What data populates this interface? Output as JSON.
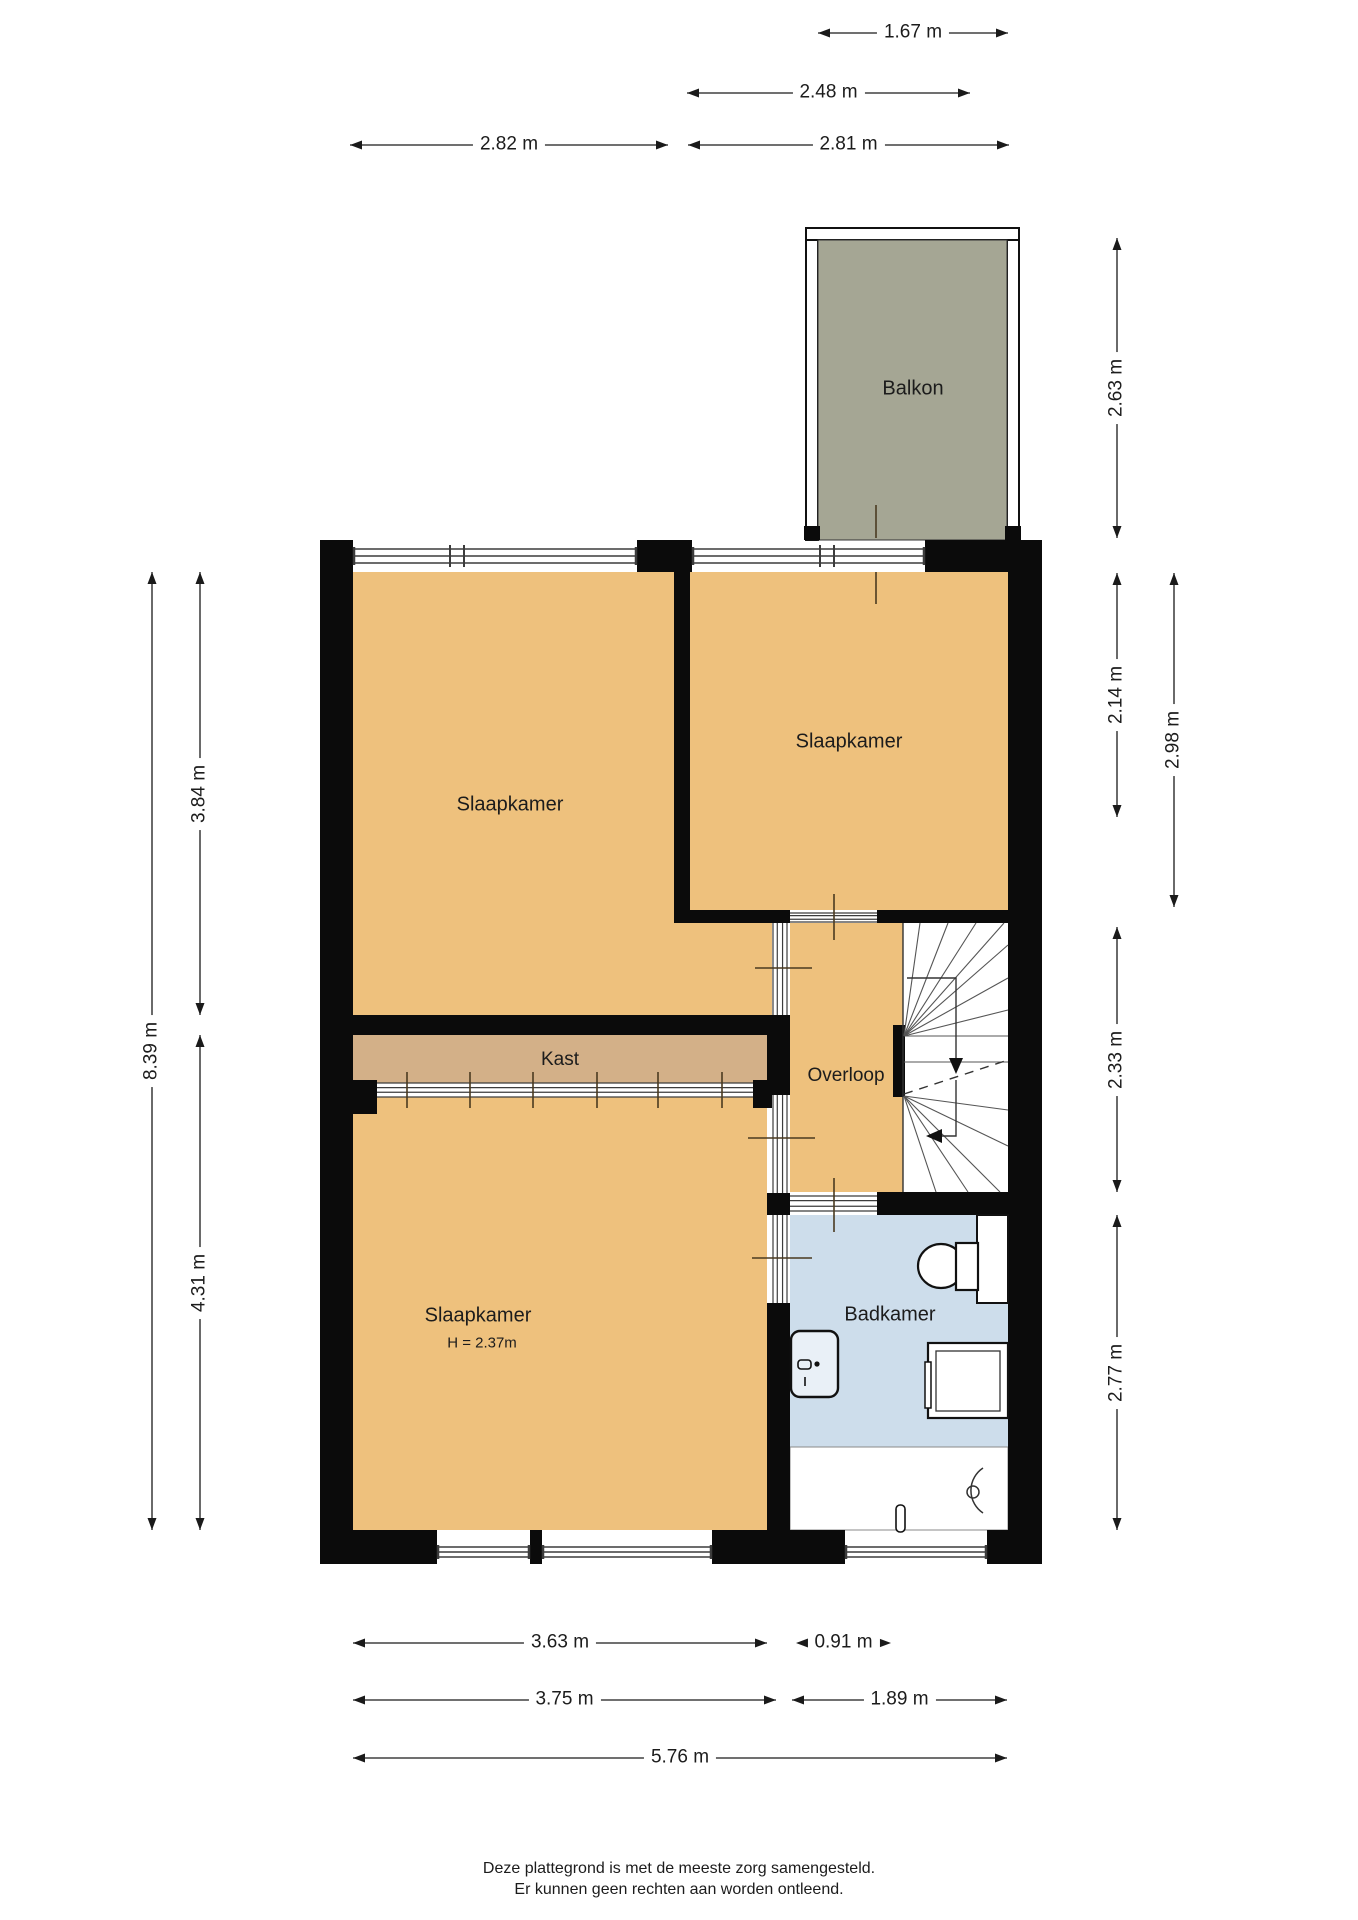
{
  "canvas": {
    "w": 1358,
    "h": 1920,
    "bg": "#ffffff"
  },
  "colors": {
    "wall": "#0b0b0b",
    "room": "#eec17d",
    "kast": "#d3b088",
    "bath": "#cdddeb",
    "balcony": "#a5a694",
    "dimline": "#1a1a1a",
    "stairline": "#555555",
    "glazeline": "#3c3c3c"
  },
  "rooms": [
    {
      "name": "room-slaapkamer-left",
      "x": 353,
      "y": 572,
      "w": 321,
      "h": 443,
      "fill": "room"
    },
    {
      "name": "room-slaapkamer-left-passage",
      "x": 674,
      "y": 923,
      "w": 98,
      "h": 92,
      "fill": "room"
    },
    {
      "name": "room-slaapkamer-right",
      "x": 690,
      "y": 572,
      "w": 318,
      "h": 338,
      "fill": "room"
    },
    {
      "name": "room-overloop",
      "x": 790,
      "y": 923,
      "w": 113,
      "h": 269,
      "fill": "room"
    },
    {
      "name": "room-kast",
      "x": 353,
      "y": 1035,
      "w": 414,
      "h": 48,
      "fill": "kast"
    },
    {
      "name": "room-slaapkamer-bottom",
      "x": 353,
      "y": 1097,
      "w": 414,
      "h": 433,
      "fill": "room"
    },
    {
      "name": "room-badkamer",
      "x": 790,
      "y": 1215,
      "w": 218,
      "h": 232,
      "fill": "bath"
    },
    {
      "name": "room-badkamer-shower-zone",
      "x": 790,
      "y": 1447,
      "w": 218,
      "h": 83,
      "fill": "#ffffff",
      "stroke": "#8a8a8a"
    },
    {
      "name": "room-stairwell",
      "x": 903,
      "y": 923,
      "w": 105,
      "h": 269,
      "fill": "#ffffff"
    }
  ],
  "walls": [
    [
      320,
      540,
      33,
      32
    ],
    [
      637,
      540,
      55,
      32
    ],
    [
      925,
      540,
      117,
      32
    ],
    [
      320,
      540,
      33,
      1024
    ],
    [
      1008,
      540,
      34,
      1024
    ],
    [
      320,
      1530,
      117,
      34
    ],
    [
      530,
      1530,
      12,
      34
    ],
    [
      712,
      1530,
      133,
      34
    ],
    [
      987,
      1530,
      55,
      34
    ],
    [
      674,
      572,
      16,
      351
    ],
    [
      674,
      910,
      116,
      13
    ],
    [
      877,
      910,
      131,
      13
    ],
    [
      353,
      1015,
      417,
      20
    ],
    [
      767,
      1015,
      23,
      80
    ],
    [
      767,
      1193,
      23,
      22
    ],
    [
      767,
      1303,
      23,
      227
    ],
    [
      353,
      1080,
      24,
      34
    ],
    [
      753,
      1080,
      24,
      28
    ],
    [
      877,
      1192,
      131,
      23
    ],
    [
      893,
      1025,
      12,
      72
    ]
  ],
  "windows": [
    {
      "name": "window-top-left",
      "x1": 353,
      "x2": 637,
      "y": 548,
      "h": 16,
      "mullions": [
        450,
        464
      ]
    },
    {
      "name": "window-balcony-door",
      "x1": 692,
      "x2": 925,
      "y": 548,
      "h": 16,
      "mullions": [
        820,
        834
      ]
    },
    {
      "name": "window-bottom-left-a",
      "x1": 437,
      "x2": 530,
      "y": 1546,
      "h": 12,
      "mullions": []
    },
    {
      "name": "window-bottom-left-b",
      "x1": 542,
      "x2": 712,
      "y": 1546,
      "h": 12,
      "mullions": []
    },
    {
      "name": "window-bottom-badkamer",
      "x1": 845,
      "x2": 987,
      "y": 1546,
      "h": 12,
      "mullions": []
    }
  ],
  "glazings": [
    {
      "name": "opening-passage-overloop",
      "x": 772,
      "y": 923,
      "w": 16,
      "h": 92,
      "o": "v"
    },
    {
      "name": "door-slaapkamer-overloop",
      "x": 772,
      "y": 1095,
      "w": 16,
      "h": 98,
      "o": "v"
    },
    {
      "name": "door-slaapkamer-badkamer",
      "x": 772,
      "y": 1215,
      "w": 16,
      "h": 88,
      "o": "v"
    },
    {
      "name": "door-slaapkamer-right-overloop",
      "x": 790,
      "y": 912,
      "w": 87,
      "h": 11,
      "o": "h"
    },
    {
      "name": "door-overloop-badkamer",
      "x": 790,
      "y": 1195,
      "w": 87,
      "h": 17,
      "o": "h"
    }
  ],
  "door_marks": [
    [
      834,
      894,
      834,
      940
    ],
    [
      755,
      968,
      812,
      968
    ],
    [
      748,
      1138,
      815,
      1138
    ],
    [
      752,
      1258,
      812,
      1258
    ],
    [
      834,
      1178,
      834,
      1232
    ],
    [
      876,
      505,
      876,
      538
    ],
    [
      876,
      572,
      876,
      604
    ]
  ],
  "kast_track": {
    "x1": 377,
    "x2": 753,
    "y": 1083,
    "h": 14,
    "ticks": [
      407,
      470,
      533,
      597,
      658,
      722
    ]
  },
  "balcony": {
    "grey": {
      "x": 818,
      "y": 240,
      "w": 189,
      "h": 300
    },
    "rails": [
      [
        806,
        228,
        12,
        312
      ],
      [
        1007,
        228,
        12,
        312
      ],
      [
        806,
        228,
        213,
        12
      ]
    ],
    "feet": [
      [
        804,
        526,
        16,
        14
      ],
      [
        1005,
        526,
        16,
        14
      ]
    ]
  },
  "stairs": {
    "edge": [
      903,
      923,
      903,
      1192
    ],
    "lines": [
      [
        904,
        1036,
        920,
        923
      ],
      [
        904,
        1036,
        948,
        923
      ],
      [
        904,
        1036,
        976,
        923
      ],
      [
        904,
        1036,
        1004,
        923
      ],
      [
        904,
        1036,
        1008,
        945
      ],
      [
        904,
        1036,
        1008,
        978
      ],
      [
        904,
        1036,
        1008,
        1010
      ],
      [
        904,
        1036,
        1008,
        1036
      ],
      [
        904,
        1062,
        1008,
        1062
      ],
      [
        904,
        1096,
        1008,
        1110
      ],
      [
        904,
        1096,
        1008,
        1146
      ],
      [
        904,
        1096,
        1000,
        1192
      ],
      [
        904,
        1096,
        968,
        1192
      ],
      [
        904,
        1096,
        936,
        1192
      ]
    ],
    "dashed": [
      904,
      1094,
      1008,
      1060
    ],
    "walk_up": "M907,978 L956,978 L956,1062",
    "walk_down": "M956,1080 L956,1136 L936,1136",
    "arrow_down": [
      956,
      1074
    ],
    "arrow_left": [
      926,
      1136
    ]
  },
  "bath": {
    "niche": [
      977,
      1215,
      31,
      88
    ],
    "tank": [
      956,
      1243,
      22,
      47
    ],
    "bowl": {
      "cx": 941,
      "cy": 1266,
      "rx": 23,
      "ry": 22
    },
    "sink": [
      791,
      1331,
      47,
      66
    ],
    "faucet_rect": [
      798,
      1360,
      13,
      9
    ],
    "faucet_dot": [
      817,
      1364
    ],
    "faucet_tick": [
      805,
      1377,
      805,
      1386
    ],
    "shower_outer": [
      928,
      1343,
      80,
      75
    ],
    "shower_inner": [
      936,
      1351,
      64,
      60
    ],
    "shower_strip": [
      925,
      1362,
      6,
      46
    ],
    "arc": {
      "x": 983,
      "y1": 1468,
      "y2": 1513,
      "r": 27
    },
    "drain": [
      973,
      1492,
      6
    ],
    "handle": [
      896,
      1505,
      9,
      27
    ]
  },
  "dims_h": [
    {
      "label": "1.67 m",
      "x1": 818,
      "x2": 1008,
      "y": 33
    },
    {
      "label": "2.48 m",
      "x1": 687,
      "x2": 970,
      "y": 93
    },
    {
      "label": "2.82 m",
      "x1": 350,
      "x2": 668,
      "y": 145
    },
    {
      "label": "2.81 m",
      "x1": 688,
      "x2": 1009,
      "y": 145
    },
    {
      "label": "3.63 m",
      "x1": 353,
      "x2": 767,
      "y": 1643
    },
    {
      "label": "0.91 m",
      "x1": 792,
      "x2": 895,
      "y": 1643,
      "style": "out"
    },
    {
      "label": "3.75 m",
      "x1": 353,
      "x2": 776,
      "y": 1700
    },
    {
      "label": "1.89 m",
      "x1": 792,
      "x2": 1007,
      "y": 1700
    },
    {
      "label": "5.76 m",
      "x1": 353,
      "x2": 1007,
      "y": 1758
    }
  ],
  "dims_v": [
    {
      "label": "8.39 m",
      "y1": 572,
      "y2": 1530,
      "x": 152
    },
    {
      "label": "3.84 m",
      "y1": 572,
      "y2": 1015,
      "x": 200
    },
    {
      "label": "4.31 m",
      "y1": 1035,
      "y2": 1530,
      "x": 200
    },
    {
      "label": "2.63 m",
      "y1": 238,
      "y2": 538,
      "x": 1117
    },
    {
      "label": "2.14 m",
      "y1": 573,
      "y2": 817,
      "x": 1117
    },
    {
      "label": "2.98 m",
      "y1": 573,
      "y2": 907,
      "x": 1174
    },
    {
      "label": "2.33 m",
      "y1": 927,
      "y2": 1192,
      "x": 1117
    },
    {
      "label": "2.77 m",
      "y1": 1215,
      "y2": 1530,
      "x": 1117
    }
  ],
  "labels": [
    {
      "name": "label-balkon",
      "text": "Balkon",
      "x": 913,
      "y": 389,
      "size": 20
    },
    {
      "name": "label-slaapkamer-left",
      "text": "Slaapkamer",
      "x": 510,
      "y": 805,
      "size": 20
    },
    {
      "name": "label-slaapkamer-right",
      "text": "Slaapkamer",
      "x": 849,
      "y": 742,
      "size": 20
    },
    {
      "name": "label-kast",
      "text": "Kast",
      "x": 560,
      "y": 1060,
      "size": 19
    },
    {
      "name": "label-overloop",
      "text": "Overloop",
      "x": 846,
      "y": 1076,
      "size": 19
    },
    {
      "name": "label-slaapkamer-bottom",
      "text": "Slaapkamer",
      "x": 478,
      "y": 1316,
      "size": 20
    },
    {
      "name": "label-height-note",
      "text": "H = 2.37m",
      "x": 482,
      "y": 1343,
      "size": 15
    },
    {
      "name": "label-badkamer",
      "text": "Badkamer",
      "x": 890,
      "y": 1315,
      "size": 20
    }
  ],
  "footer": {
    "line1": "Deze plattegrond is met de meeste zorg samengesteld.",
    "line2": "Er kunnen geen rechten aan worden ontleend.",
    "y": 1858
  }
}
